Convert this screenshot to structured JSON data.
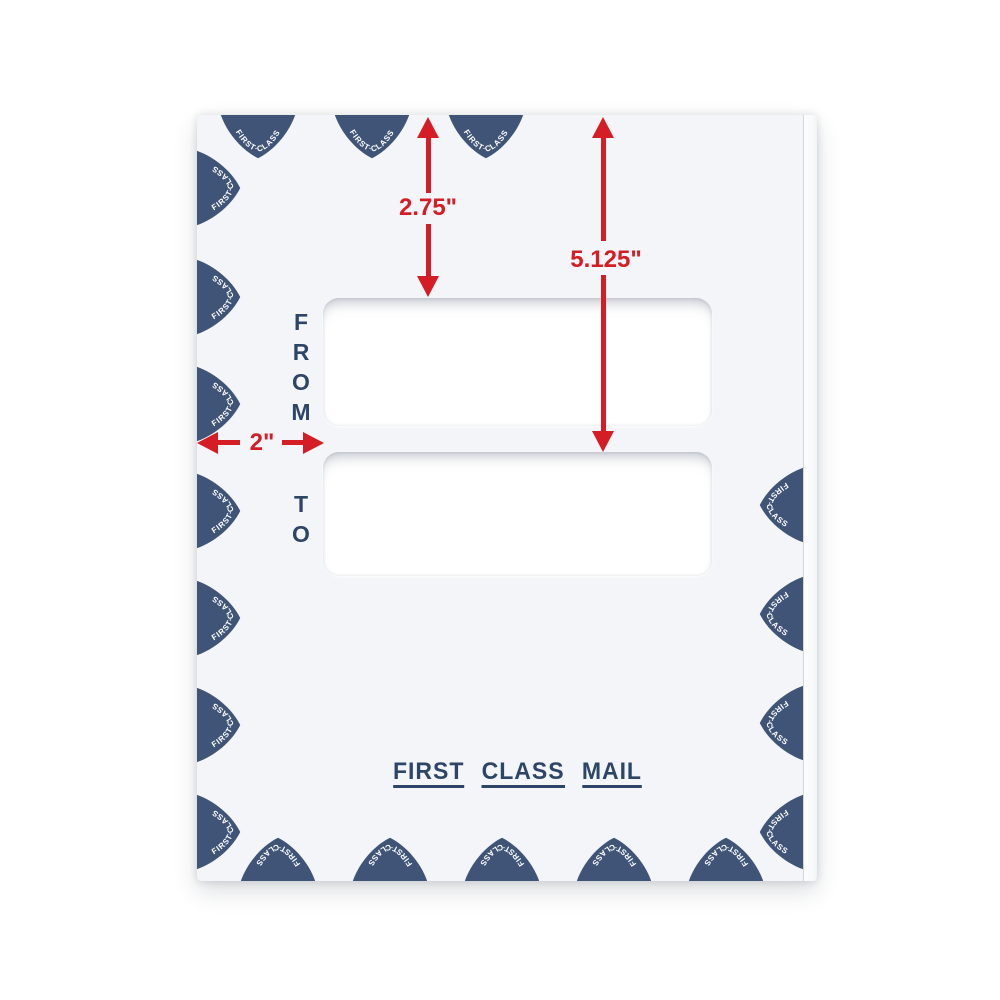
{
  "envelope": {
    "from_label": "FROM",
    "to_label": "TO",
    "stamp": {
      "text": "FIRST·CLASS"
    },
    "footer": {
      "words": [
        "FIRST",
        "CLASS",
        "MAIL"
      ]
    }
  },
  "measurements": {
    "top_to_from_window": "2.75\"",
    "top_to_to_window": "5.125\"",
    "left_to_windows": "2\""
  },
  "colors": {
    "accent_red": "#d41d24",
    "navy": "#2d4668",
    "stamp_fill": "#3f5477",
    "envelope_face": "#f3f5f8"
  }
}
